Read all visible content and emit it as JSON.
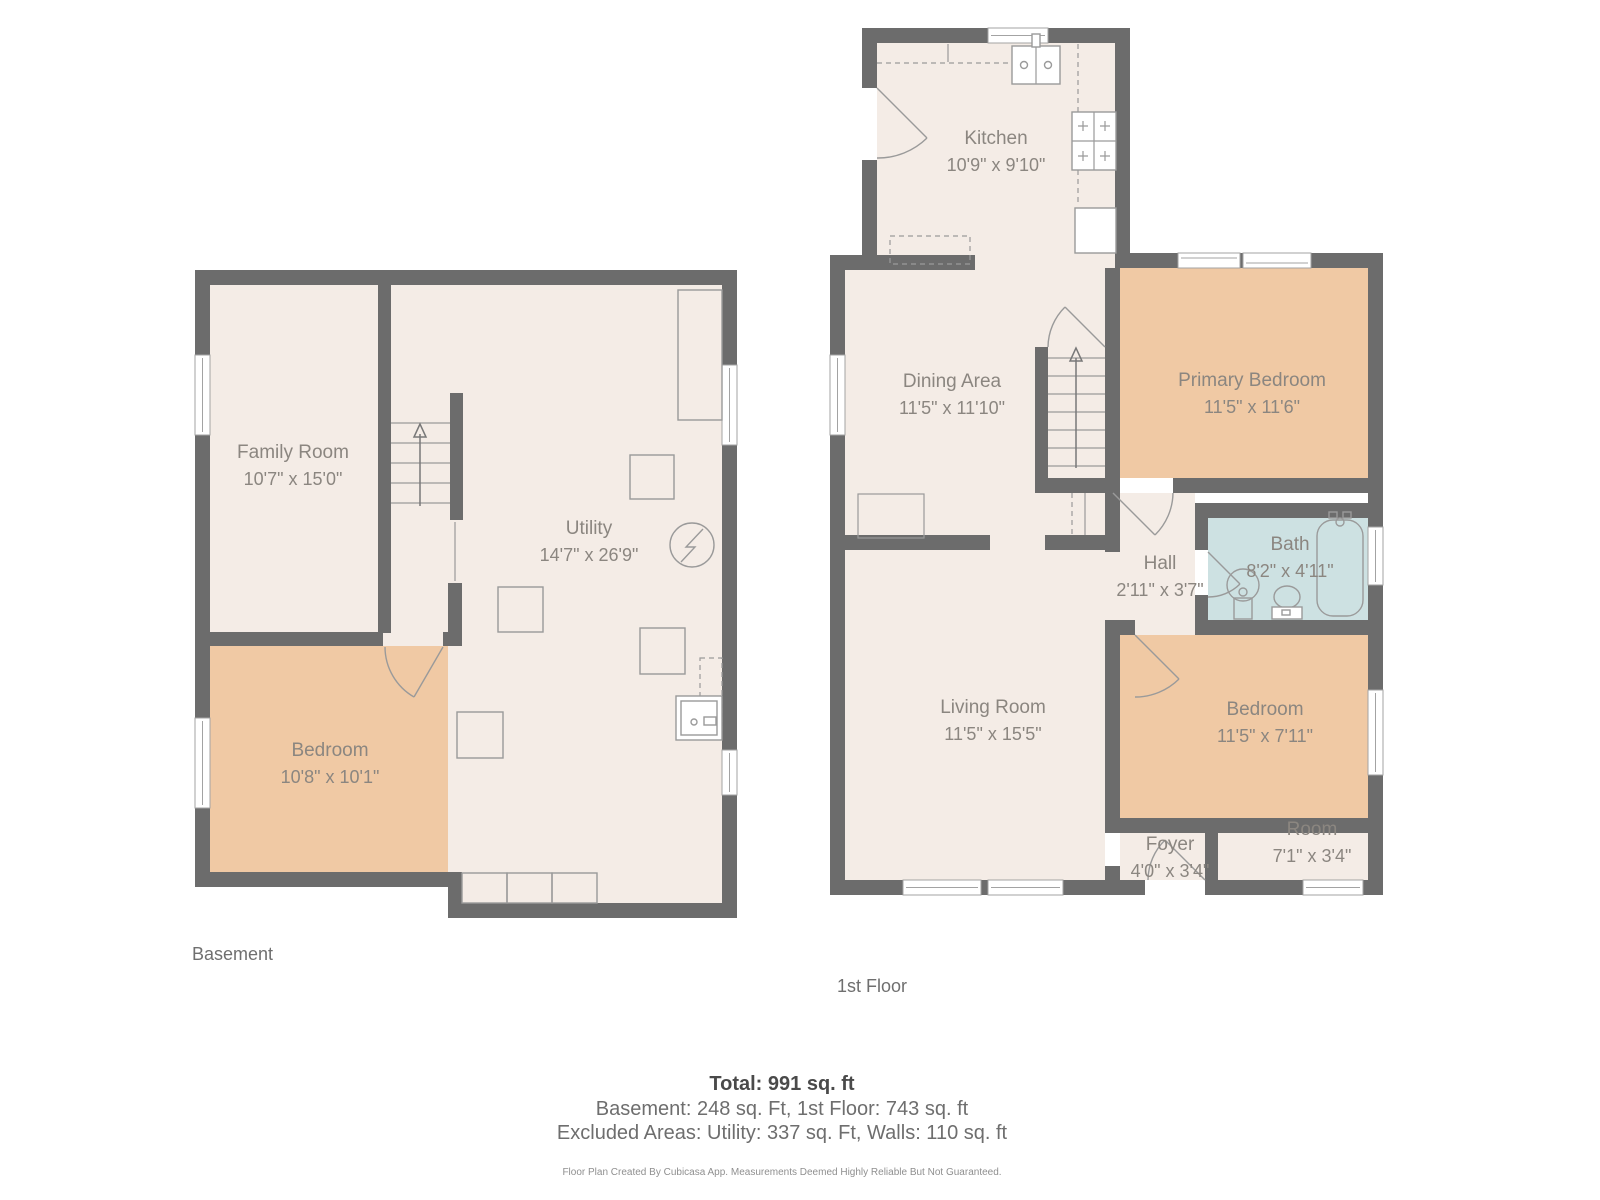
{
  "colors": {
    "wall": "#6c6c6c",
    "floor": "#f4ece6",
    "bedroom_fill": "#f0c9a4",
    "bath_fill": "#cde1e2",
    "fixture_stroke": "#9a9a9a",
    "window_stroke": "#a3a3a3",
    "label_text": "#8b8680"
  },
  "floors": [
    {
      "label": "Basement",
      "rooms": [
        {
          "name": "Family Room",
          "dims": "10'7\" x 15'0\""
        },
        {
          "name": "Utility",
          "dims": "14'7\" x 26'9\""
        },
        {
          "name": "Bedroom",
          "dims": "10'8\" x 10'1\""
        }
      ]
    },
    {
      "label": "1st Floor",
      "rooms": [
        {
          "name": "Kitchen",
          "dims": "10'9\" x 9'10\""
        },
        {
          "name": "Dining Area",
          "dims": "11'5\" x 11'10\""
        },
        {
          "name": "Primary Bedroom",
          "dims": "11'5\" x 11'6\""
        },
        {
          "name": "Hall",
          "dims": "2'11\" x 3'7\""
        },
        {
          "name": "Bath",
          "dims": "8'2\" x 4'11\""
        },
        {
          "name": "Living Room",
          "dims": "11'5\" x 15'5\""
        },
        {
          "name": "Bedroom",
          "dims": "11'5\" x 7'11\""
        },
        {
          "name": "Foyer",
          "dims": "4'0\" x 3'4\""
        },
        {
          "name": "Room",
          "dims": "7'1\" x 3'4\""
        }
      ]
    }
  ],
  "footer": {
    "total": "Total: 991 sq. ft",
    "breakdown": "Basement: 248 sq. Ft, 1st Floor: 743 sq. ft",
    "excluded": "Excluded Areas: Utility: 337 sq. Ft, Walls: 110 sq. ft",
    "disclaimer": "Floor Plan Created By Cubicasa App. Measurements Deemed Highly Reliable But Not Guaranteed."
  }
}
